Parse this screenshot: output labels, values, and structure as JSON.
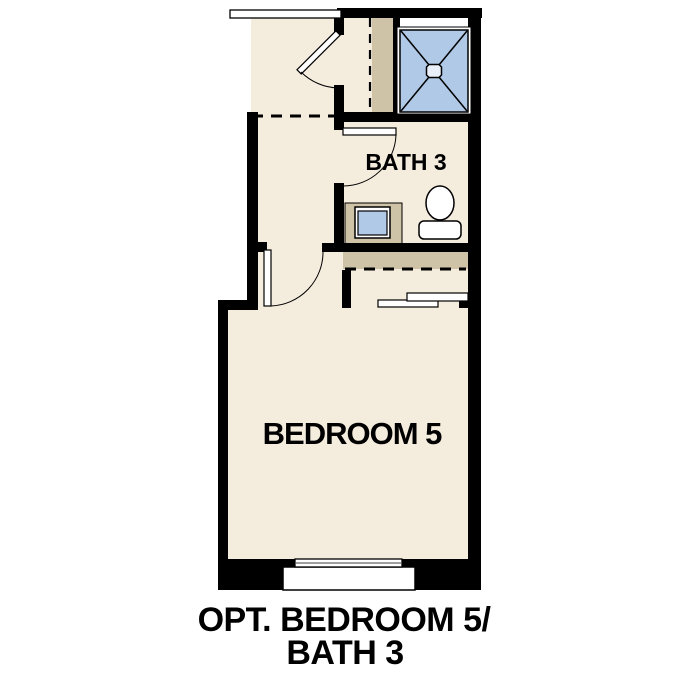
{
  "plan": {
    "type": "floor-plan-option-diagram",
    "rooms": [
      {
        "id": "bath",
        "label": "BATH 3"
      },
      {
        "id": "bedroom",
        "label": "BEDROOM 5"
      }
    ],
    "labels": {
      "bath": "BATH 3",
      "bedroom": "BEDROOM 5"
    },
    "caption": {
      "line1": "OPT. BEDROOM 5/",
      "line2": "BATH 3"
    },
    "fixtures": [
      "shower-with-x-and-drain",
      "vanity-with-sink",
      "toilet",
      "linen-closet-with-dashed-shelf-line",
      "bedroom-closet-shelf-and-rod",
      "bypass-closet-doors",
      "window",
      "swing-door-hall",
      "swing-door-bath",
      "swing-door-bedroom",
      "cased-opening-top",
      "dashed-header-opening"
    ],
    "colors": {
      "wall": "#000000",
      "floor": "#f4ecdd",
      "cabinetry": "#cec2a7",
      "shower_blue": "#b0c9e7",
      "drain_fill": "#e9f0f9",
      "background": "#ffffff"
    }
  }
}
